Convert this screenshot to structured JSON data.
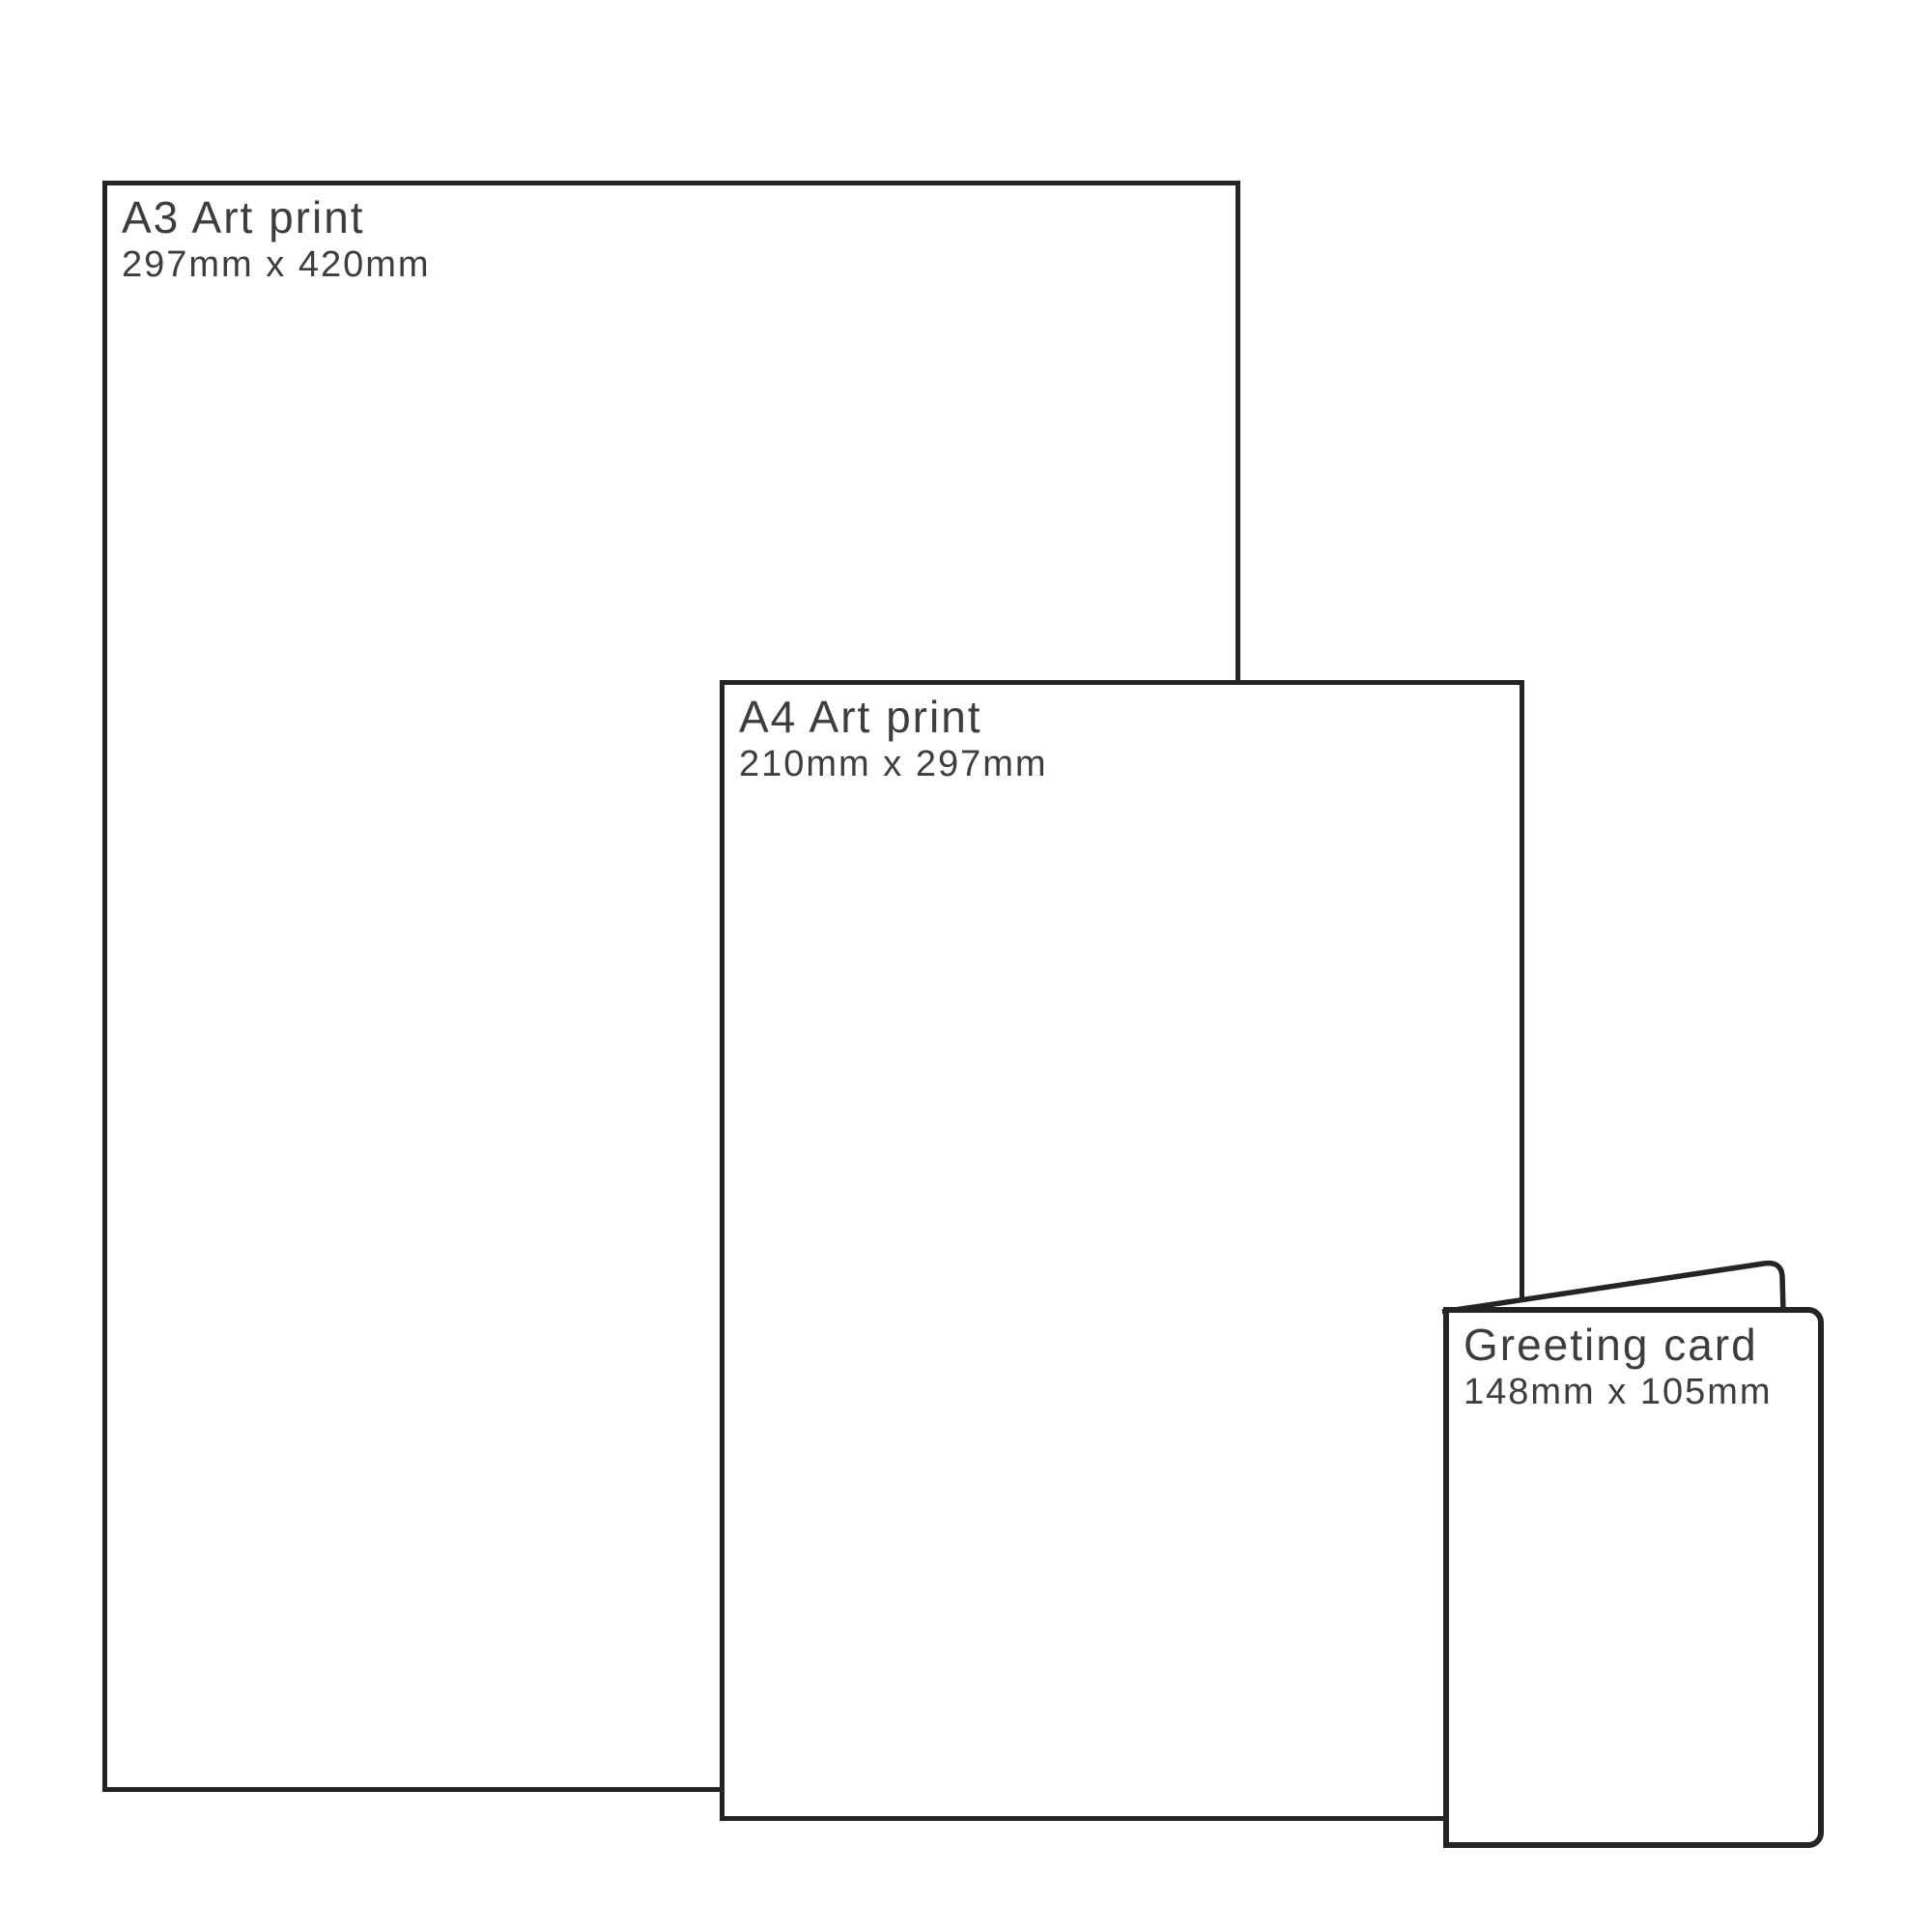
{
  "page": {
    "background": "#ffffff",
    "description": "Print size comparison diagram"
  },
  "colors": {
    "outline": "#242424",
    "text": "#3d3d3d"
  },
  "items": [
    {
      "id": "a3",
      "title": "A3 Art print",
      "dimensions": "297mm x 420mm"
    },
    {
      "id": "a4",
      "title": "A4 Art print",
      "dimensions": "210mm x 297mm"
    },
    {
      "id": "greeting-card",
      "title": "Greeting card",
      "dimensions": "148mm x 105mm"
    }
  ]
}
